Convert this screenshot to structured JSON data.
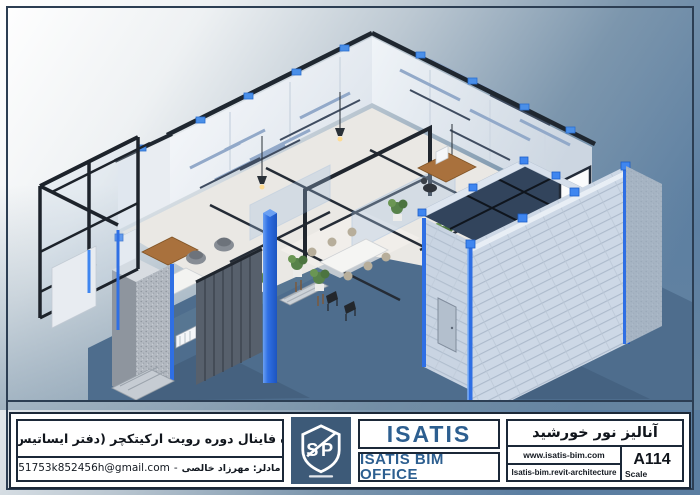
{
  "sheet": {
    "frame_color": "#2c3e53",
    "accent_blue": "#2f6fe4",
    "clip_blue": "#4a8fe8",
    "ground_color": "#4e6d8d",
    "background_steel_blue": "#5b7ea1",
    "logo_background": "#3d5a78",
    "company_text_color": "#2d5f90"
  },
  "title_block": {
    "project": {
      "title_fa": "پروژه فاینال دوره رویت ارکیتکچر (دفتر ایساتیس بیم)",
      "modeler_fa": "بیم مادلر: مهرزاد خالصی",
      "dash": "-",
      "email": "m951753k852456h@gmail.com"
    },
    "logo": {
      "text": "SP"
    },
    "company": {
      "name": "ISATIS",
      "subtitle": "ISATIS BIM OFFICE"
    },
    "drawing": {
      "title_fa": "آنالیز نور خورشید",
      "website": "www.isatis-bim.com",
      "course": "Isatis-bim.revit-architecture",
      "sheet_number": "A114",
      "scale_label": "Scale"
    }
  }
}
